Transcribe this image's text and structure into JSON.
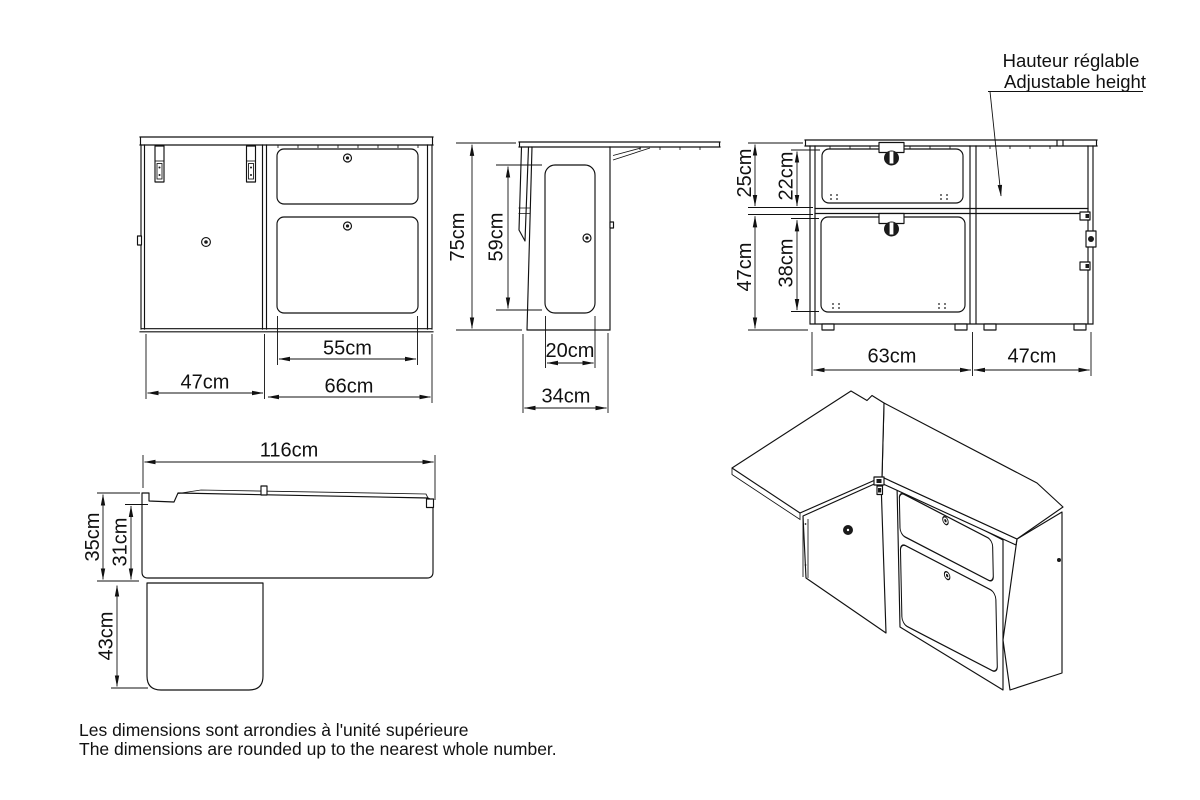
{
  "annotation": {
    "title_fr": "Hauteur réglable",
    "title_en": "Adjustable height"
  },
  "footer": {
    "note_fr": "Les dimensions sont arrondies à l'unité supérieure",
    "note_en": "The dimensions are rounded up to the nearest whole number."
  },
  "dims": {
    "front": {
      "opening_width": "55cm",
      "door_width": "47cm",
      "drawer_section_width": "66cm"
    },
    "side": {
      "total_height": "75cm",
      "door_height": "59cm",
      "door_width": "20cm",
      "depth": "34cm"
    },
    "rear": {
      "upper_section": "25cm",
      "upper_opening": "22cm",
      "lower_section": "47cm",
      "lower_opening": "38cm",
      "left_section_width": "63cm",
      "right_section_width": "47cm"
    },
    "top": {
      "total_width": "116cm",
      "depth_total": "35cm",
      "depth_body": "31cm",
      "table_depth": "43cm"
    }
  },
  "colors": {
    "line": "#111111",
    "background": "#ffffff"
  }
}
